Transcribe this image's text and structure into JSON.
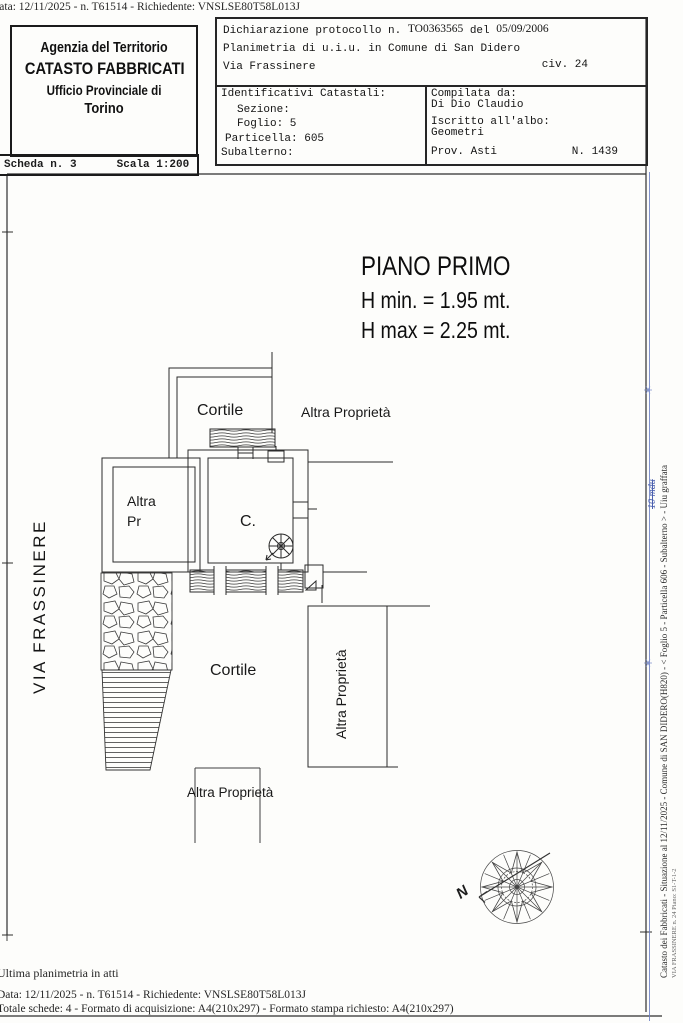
{
  "top_bar": {
    "text": "Data: 12/11/2025 - n. T61514 - Richiedente: VNSLSE80T58L013J"
  },
  "header": {
    "agency": {
      "line1": "Agenzia del Territorio",
      "line2": "CATASTO FABBRICATI",
      "line3": "Ufficio Provinciale di",
      "line4": "Torino"
    },
    "scheda": {
      "label": "Scheda n. 3",
      "scale": "Scala 1:200"
    },
    "declaration": {
      "prefix": "Dichiarazione protocollo n.",
      "protocol": "TO0363565",
      "del_label": "del",
      "date": "05/09/2006",
      "line2": "Planimetria di u.i.u. in Comune di San Didero",
      "street": "Via Frassinere",
      "civ": "civ. 24"
    },
    "identificativi": {
      "title": "Identificativi Catastali:",
      "sezione": "Sezione:",
      "foglio": "Foglio: 5",
      "particella": "Particella: 605",
      "subalterno": "Subalterno:"
    },
    "compilata": {
      "title": "Compilata da:",
      "name": "Di Dio Claudio",
      "albo_label": "Iscritto all'albo:",
      "albo": "Geometri",
      "prov": "Prov. Asti",
      "number": "N. 1439"
    }
  },
  "plan": {
    "title": "PIANO PRIMO",
    "h_min": "H min. = 1.95 mt.",
    "h_max": "H max = 2.25 mt.",
    "labels": {
      "cortile_top": "Cortile",
      "altra_proprieta_top": "Altra Proprietà",
      "altra": "Altra",
      "pr": "Pr",
      "room_c": "C.",
      "cortile_bottom": "Cortile",
      "altra_proprieta_right": "Altra Proprietà",
      "altra_proprieta_bottom": "Altra Proprietà",
      "street": "VIA  FRASSINERE",
      "north": "N"
    }
  },
  "right_margin": {
    "main": "Catasto dei Fabbricati - Situazione al 12/11/2025 - Comune di SAN DIDERO(H820) - < Foglio 5 - Particella 606 - Subalterno > - Uiu graffata",
    "sub": "VIA FRASSINERE n. 24 Piano: S1-T-1-2",
    "annotation": "10 mdu"
  },
  "footer": {
    "line1": "Ultima planimetria in atti",
    "line2": "Data: 12/11/2025 - n. T61514 - Richiedente: VNSLSE80T58L013J",
    "line3": "Totale schede: 4 - Formato di acquisizione: A4(210x297)  - Formato stampa richiesto: A4(210x297)"
  },
  "colors": {
    "ink": "#2b2b2b",
    "blue_annotation": "#4a5fae",
    "paper": "#fdfdfb"
  }
}
